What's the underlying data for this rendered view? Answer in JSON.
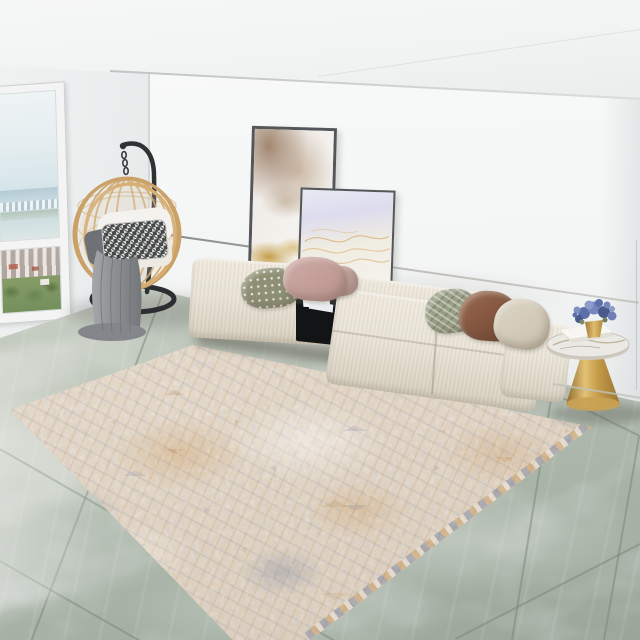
{
  "meta": {
    "width": 640,
    "height": 640,
    "scene_label": "Bright modern living room with a beige modular sofa, rattan hanging egg chair, leaning abstract artworks, gold pedestal side table and a distressed vintage rug on green-grey marble tiles"
  },
  "palette": {
    "wall": "#f6f7f7",
    "ceiling": "#f2f3f3",
    "wall-left": "#ebeeee",
    "panel-line": "#8b8d90",
    "window-frame": "#f3f4f3",
    "window-sky": "#e6eef1",
    "window-trees": "#7e9465",
    "rattan": "#cda46c",
    "stand-black": "#303336",
    "chair-cushion": "#f3f1ec",
    "houndstooth": "#45484b",
    "throw-grey": "#8f9295",
    "art-frame": "#54575a",
    "art-taupe": "#b39a82",
    "art-gold": "#c6a04e",
    "art-lavender": "#dddcee",
    "art-gold-line": "#d8a75c",
    "sofa": "#e9e3d6",
    "sofa-shade": "#d9d2c2",
    "console": "#17181a",
    "paper": "#f4f4f2",
    "pillow-olive": "#8e9076",
    "pillow-pink": "#c8a49e",
    "pillow-chevron": "#99a087",
    "pillow-brown": "#8a5c46",
    "pillow-beige": "#d8d0bf",
    "table-gold": "#c99d4f",
    "table-marble": "#eae8e2",
    "flower-blue": "#5d6fa8",
    "book-white": "#f6f5f2",
    "floor": "#aeb8ac",
    "grout": "#7f8a7e",
    "rug-base": "#e0d5c7",
    "rug-orange": "#c4893e",
    "rug-blue": "#68789b",
    "rug-light": "#f4efe7"
  },
  "objects": {
    "window": {
      "label": "floor-to-ceiling window with hazy city and treetop view"
    },
    "hanging_chair": {
      "label": "round rattan hanging egg chair on black curved stand with white cushion, houndstooth pillow and grey knit throw"
    },
    "artwork_large": {
      "label": "large leaning abstract artwork with taupe marbling and gold leaf"
    },
    "artwork_small": {
      "label": "smaller leaning artwork with lavender wash and gold line strokes"
    },
    "sofa": {
      "label": "beige modular sectional sofa with chaise and accent pillows"
    },
    "console": {
      "label": "black integrated side console with magazines"
    },
    "side_table": {
      "label": "gold pedestal side table with marble top, white book and blue hydrangeas"
    },
    "rug": {
      "label": "distressed beige oriental rug with amber and blue-grey medallion pattern"
    },
    "floor": {
      "label": "green-grey polished marble tile floor"
    },
    "ceiling": {
      "label": "white ceiling with soffit"
    },
    "walls": {
      "label": "white walls with recessed panel line"
    }
  }
}
